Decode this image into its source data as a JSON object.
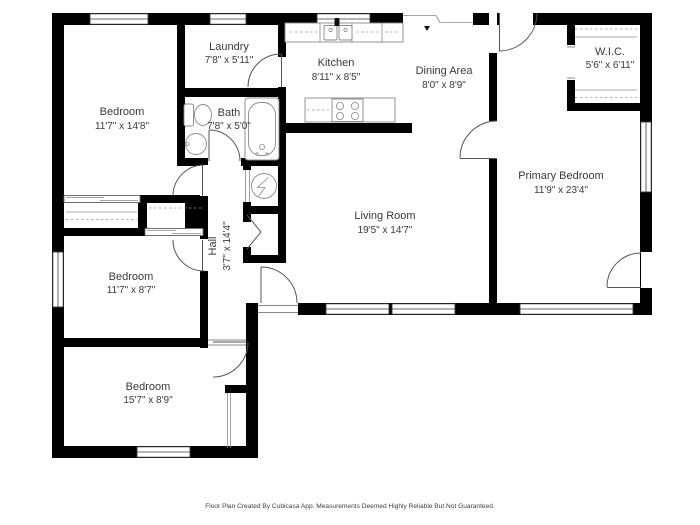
{
  "colors": {
    "wall": "#000000",
    "label_text": "#3a3a3a",
    "fixture_stroke": "#8a8a8a",
    "background": "#ffffff"
  },
  "rooms": [
    {
      "name": "Bedroom",
      "dims": "11'7\" x 14'8\""
    },
    {
      "name": "Laundry",
      "dims": "7'8\" x 5'11\""
    },
    {
      "name": "Bath",
      "dims": "7'8\" x 5'0\""
    },
    {
      "name": "Kitchen",
      "dims": "8'11\" x 8'5\""
    },
    {
      "name": "Dining Area",
      "dims": "8'0\" x 8'9\""
    },
    {
      "name": "W.I.C.",
      "dims": "5'6\" x 6'11\""
    },
    {
      "name": "Primary Bedroom",
      "dims": "11'9\" x 23'4\""
    },
    {
      "name": "Living Room",
      "dims": "19'5\" x 14'7\""
    },
    {
      "name": "Hall",
      "dims": "3'7\" x 14'4\""
    },
    {
      "name": "Bedroom",
      "dims": "11'7\" x 8'7\""
    },
    {
      "name": "Bedroom",
      "dims": "15'7\" x 8'9\""
    }
  ],
  "footer": "Floor Plan Created By Cubicasa App. Measurements Deemed Highly Reliable But Not Guaranteed."
}
